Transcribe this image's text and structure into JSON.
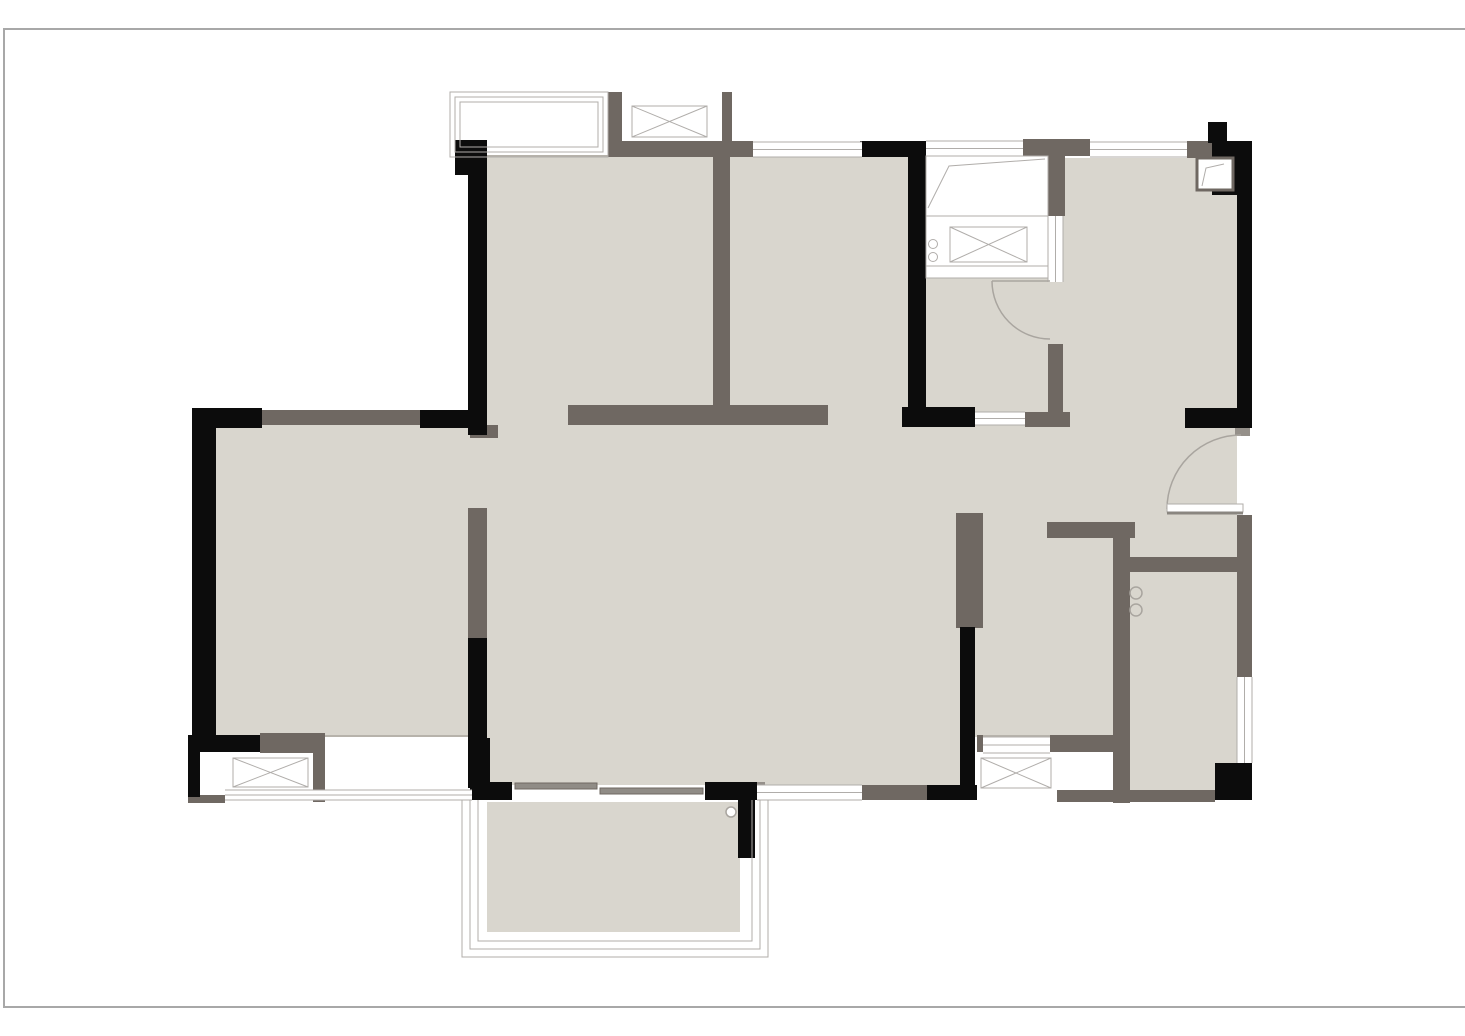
{
  "meta": {
    "title": "apartment-floor-plan",
    "has_text": false
  },
  "canvas": {
    "w": 1465,
    "h": 1036,
    "background": "#ffffff"
  },
  "frame": {
    "x": 3,
    "y": 28,
    "w": 1470,
    "h": 976,
    "stroke": "#a8a8a8"
  },
  "colors": {
    "floor": "#d9d6ce",
    "floor_edge": "#b7b3ab",
    "wall_black": "#0c0c0c",
    "wall_gray": "#6f6862",
    "wall_gray_light": "#95908a",
    "line": "#b0adaa",
    "arc": "#a9a59f",
    "leaf_shadow": "#8a8680",
    "slider": "#908c86",
    "white": "#ffffff"
  },
  "floors": [
    {
      "name": "bedroom-top-left-floor",
      "x": 487,
      "y": 157,
      "w": 226,
      "h": 268
    },
    {
      "name": "bedroom-top-middle-floor",
      "x": 730,
      "y": 157,
      "w": 178,
      "h": 268
    },
    {
      "name": "kitchen-floor",
      "x": 926,
      "y": 278,
      "w": 122,
      "h": 134
    },
    {
      "name": "kitchen-door-gap-floor",
      "x": 1048,
      "y": 282,
      "w": 20,
      "h": 62
    },
    {
      "name": "dining-floor",
      "x": 1063,
      "y": 158,
      "w": 174,
      "h": 364
    },
    {
      "name": "hallway-floor",
      "x": 908,
      "y": 425,
      "w": 329,
      "h": 97
    },
    {
      "name": "bathroom-door-gap-floor",
      "x": 983,
      "y": 522,
      "w": 64,
      "h": 16
    },
    {
      "name": "living-room-floor",
      "x": 487,
      "y": 425,
      "w": 473,
      "h": 360
    },
    {
      "name": "left-bedroom-floor",
      "x": 216,
      "y": 425,
      "w": 254,
      "h": 312
    },
    {
      "name": "left-bedroom-door-gap-floor",
      "x": 470,
      "y": 437,
      "w": 17,
      "h": 71
    },
    {
      "name": "bedroom-top-middle-door-gap-floor",
      "x": 828,
      "y": 405,
      "w": 80,
      "h": 20
    },
    {
      "name": "bedroom-top-left-door-gap-floor",
      "x": 487,
      "y": 405,
      "w": 81,
      "h": 20
    },
    {
      "name": "bathroom-floor",
      "x": 975,
      "y": 538,
      "w": 140,
      "h": 199
    },
    {
      "name": "utility-room-floor",
      "x": 1130,
      "y": 572,
      "w": 107,
      "h": 221
    },
    {
      "name": "entry-nook-floor",
      "x": 1130,
      "y": 522,
      "w": 107,
      "h": 50
    },
    {
      "name": "balcony-floor",
      "x": 487,
      "y": 802,
      "w": 253,
      "h": 130
    }
  ],
  "edge_lines": [
    {
      "name": "bay-window-floor-edge",
      "x": 487,
      "y": 155,
      "w": 121,
      "h": 2
    },
    {
      "name": "left-bedroom-floor-edge",
      "x": 325,
      "y": 735,
      "w": 145,
      "h": 2
    },
    {
      "name": "bathroom-floor-edge",
      "x": 983,
      "y": 735,
      "w": 67,
      "h": 2
    }
  ],
  "walls_black": [
    {
      "x": 455,
      "y": 140,
      "w": 32,
      "h": 35
    },
    {
      "x": 468,
      "y": 140,
      "w": 19,
      "h": 295
    },
    {
      "x": 860,
      "y": 141,
      "w": 62,
      "h": 16
    },
    {
      "x": 908,
      "y": 141,
      "w": 18,
      "h": 286
    },
    {
      "x": 902,
      "y": 407,
      "w": 73,
      "h": 20
    },
    {
      "x": 1208,
      "y": 122,
      "w": 19,
      "h": 21
    },
    {
      "x": 1212,
      "y": 141,
      "w": 40,
      "h": 54
    },
    {
      "x": 1237,
      "y": 141,
      "w": 15,
      "h": 287
    },
    {
      "x": 1185,
      "y": 408,
      "w": 67,
      "h": 20
    },
    {
      "x": 960,
      "y": 627,
      "w": 15,
      "h": 160
    },
    {
      "x": 927,
      "y": 785,
      "w": 50,
      "h": 15
    },
    {
      "x": 950,
      "y": 787,
      "w": 27,
      "h": 13
    },
    {
      "x": 470,
      "y": 738,
      "w": 20,
      "h": 62
    },
    {
      "x": 472,
      "y": 782,
      "w": 40,
      "h": 18
    },
    {
      "x": 705,
      "y": 782,
      "w": 52,
      "h": 18
    },
    {
      "x": 738,
      "y": 800,
      "w": 17,
      "h": 58
    },
    {
      "x": 192,
      "y": 408,
      "w": 70,
      "h": 20
    },
    {
      "x": 420,
      "y": 410,
      "w": 67,
      "h": 18
    },
    {
      "x": 192,
      "y": 408,
      "w": 24,
      "h": 344
    },
    {
      "x": 188,
      "y": 735,
      "w": 72,
      "h": 17
    },
    {
      "x": 188,
      "y": 752,
      "w": 12,
      "h": 45
    },
    {
      "x": 1215,
      "y": 763,
      "w": 37,
      "h": 37
    },
    {
      "x": 468,
      "y": 638,
      "w": 19,
      "h": 150
    }
  ],
  "walls_gray": [
    {
      "x": 608,
      "y": 92,
      "w": 14,
      "h": 65
    },
    {
      "x": 722,
      "y": 92,
      "w": 10,
      "h": 65
    },
    {
      "x": 608,
      "y": 141,
      "w": 145,
      "h": 16
    },
    {
      "x": 713,
      "y": 141,
      "w": 17,
      "h": 284
    },
    {
      "x": 568,
      "y": 405,
      "w": 260,
      "h": 20
    },
    {
      "x": 1023,
      "y": 139,
      "w": 67,
      "h": 17
    },
    {
      "x": 1048,
      "y": 156,
      "w": 17,
      "h": 60
    },
    {
      "x": 1187,
      "y": 141,
      "w": 25,
      "h": 17
    },
    {
      "x": 1048,
      "y": 344,
      "w": 15,
      "h": 68
    },
    {
      "x": 1025,
      "y": 412,
      "w": 45,
      "h": 15
    },
    {
      "x": 956,
      "y": 513,
      "w": 27,
      "h": 115
    },
    {
      "x": 1047,
      "y": 522,
      "w": 88,
      "h": 16
    },
    {
      "x": 1113,
      "y": 522,
      "w": 17,
      "h": 281
    },
    {
      "x": 1130,
      "y": 557,
      "w": 110,
      "h": 15
    },
    {
      "x": 1237,
      "y": 515,
      "w": 15,
      "h": 162
    },
    {
      "x": 1050,
      "y": 735,
      "w": 63,
      "h": 17
    },
    {
      "x": 1057,
      "y": 790,
      "w": 56,
      "h": 12
    },
    {
      "x": 1130,
      "y": 790,
      "w": 85,
      "h": 12
    },
    {
      "x": 260,
      "y": 410,
      "w": 160,
      "h": 15
    },
    {
      "x": 468,
      "y": 508,
      "w": 19,
      "h": 130
    },
    {
      "x": 260,
      "y": 733,
      "w": 65,
      "h": 20
    },
    {
      "x": 313,
      "y": 752,
      "w": 12,
      "h": 50
    },
    {
      "x": 188,
      "y": 795,
      "w": 37,
      "h": 8
    },
    {
      "x": 862,
      "y": 785,
      "w": 65,
      "h": 15
    },
    {
      "x": 470,
      "y": 425,
      "w": 28,
      "h": 13
    },
    {
      "x": 977,
      "y": 735,
      "w": 6,
      "h": 17
    }
  ],
  "walls_gray_light": [
    {
      "x": 1235,
      "y": 427,
      "w": 15,
      "h": 9
    },
    {
      "x": 755,
      "y": 782,
      "w": 10,
      "h": 13
    },
    {
      "x": 902,
      "y": 408,
      "w": 8,
      "h": 19
    }
  ],
  "window_strips": [
    {
      "name": "window-bedroom-top-middle",
      "x": 753,
      "y": 142,
      "w": 109,
      "h": 15,
      "dir": "h"
    },
    {
      "name": "window-kitchen-top",
      "x": 926,
      "y": 141,
      "w": 97,
      "h": 15,
      "dir": "h"
    },
    {
      "name": "window-dining-top",
      "x": 1090,
      "y": 142,
      "w": 97,
      "h": 15,
      "dir": "h"
    },
    {
      "name": "window-kitchen-pass",
      "x": 1048,
      "y": 216,
      "w": 15,
      "h": 66,
      "dir": "v"
    },
    {
      "name": "window-kitchen-hall",
      "x": 975,
      "y": 412,
      "w": 50,
      "h": 13,
      "dir": "h"
    },
    {
      "name": "window-living-bottom",
      "x": 757,
      "y": 785,
      "w": 105,
      "h": 15,
      "dir": "h"
    },
    {
      "name": "window-utility-right",
      "x": 1237,
      "y": 677,
      "w": 15,
      "h": 86,
      "dir": "v"
    },
    {
      "name": "window-left-bedroom-bottom",
      "x": 225,
      "y": 790,
      "w": 247,
      "h": 10,
      "dir": "h"
    },
    {
      "name": "window-bathroom-bottom",
      "x": 983,
      "y": 737,
      "w": 67,
      "h": 16,
      "dir": "h"
    }
  ],
  "outline_boxes": [
    {
      "name": "bay-window-outline",
      "x": 450,
      "y": 92,
      "w": 158,
      "h": 65,
      "insets": [
        0,
        5,
        10
      ],
      "open": "none"
    },
    {
      "name": "balcony-railing",
      "x": 462,
      "y": 800,
      "w": 306,
      "h": 157,
      "insets": [
        0,
        8,
        16
      ],
      "open": "top"
    }
  ],
  "x_boxes": [
    {
      "name": "ac-platform-top",
      "x": 632,
      "y": 106,
      "w": 75,
      "h": 31
    },
    {
      "name": "kitchen-sink",
      "x": 950,
      "y": 227,
      "w": 77,
      "h": 35
    },
    {
      "name": "ac-platform-left",
      "x": 233,
      "y": 758,
      "w": 75,
      "h": 29
    },
    {
      "name": "ac-platform-bathroom",
      "x": 981,
      "y": 758,
      "w": 70,
      "h": 30
    }
  ],
  "counter": {
    "name": "kitchen-counter",
    "x": 926,
    "y": 156,
    "w": 122,
    "h": 122,
    "section_lines": [
      [
        926,
        216,
        1048,
        216
      ],
      [
        926,
        266,
        1048,
        266
      ]
    ],
    "drainboard": [
      [
        928,
        208
      ],
      [
        949,
        166
      ],
      [
        1045,
        159
      ]
    ],
    "burners": [
      {
        "cx": 933,
        "cy": 244,
        "r": 4.5
      },
      {
        "cx": 933,
        "cy": 257,
        "r": 4.5
      }
    ]
  },
  "flue_box": {
    "name": "flue-shaft",
    "x": 1197,
    "y": 158,
    "w": 36,
    "h": 32,
    "diagonal": [
      [
        1202,
        186
      ],
      [
        1206,
        168
      ],
      [
        1224,
        164
      ]
    ]
  },
  "doors": [
    {
      "name": "entry-door",
      "leaf_rect": {
        "x": 1167,
        "y": 504,
        "w": 76,
        "h": 8
      },
      "shadow": [
        1167,
        513,
        1243,
        513
      ],
      "arc": "M 1167 509 A 74 74 0 0 1 1241 435"
    },
    {
      "name": "kitchen-door",
      "leaf_line": [
        992,
        281,
        1050,
        281
      ],
      "arc": "M 992 281 A 58 58 0 0 0 1050 339"
    }
  ],
  "circles": [
    {
      "name": "utility-door-pivot-1",
      "cx": 1136,
      "cy": 593,
      "r": 6,
      "fill": "none"
    },
    {
      "name": "utility-door-pivot-2",
      "cx": 1136,
      "cy": 610,
      "r": 6,
      "fill": "none"
    },
    {
      "name": "balcony-drain",
      "cx": 731,
      "cy": 812,
      "r": 5,
      "fill": "#ffffff"
    }
  ],
  "sliding_door_panels": [
    {
      "name": "balcony-slider-panel-1",
      "x": 515,
      "y": 783,
      "w": 82,
      "h": 6
    },
    {
      "name": "balcony-slider-panel-2",
      "x": 600,
      "y": 788,
      "w": 103,
      "h": 6
    }
  ]
}
